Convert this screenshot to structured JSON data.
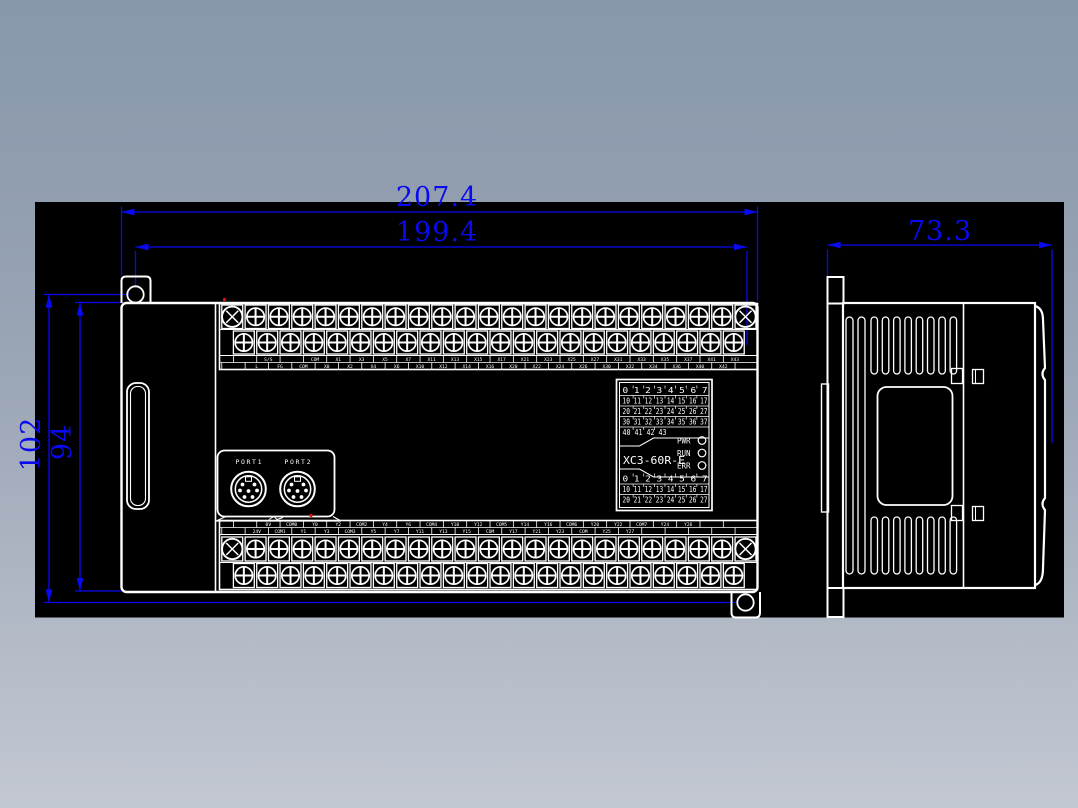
{
  "page": {
    "background_top": "#8897ab",
    "background_bottom": "#c3c8d2"
  },
  "canvas": {
    "fill": "#000000",
    "line_color": "#ffffff",
    "dimension_color": "#0a0af0",
    "marker_color": "#dd1111"
  },
  "dimensions": {
    "width_total": "207.4",
    "width_holes": "199.4",
    "height_total": "102",
    "height_body": "94",
    "side_depth": "73.3"
  },
  "front_view": {
    "model_label": "XC3-60R-E",
    "ports": [
      {
        "label": "PORT1"
      },
      {
        "label": "PORT2"
      }
    ],
    "leds": [
      {
        "label": "PWR"
      },
      {
        "label": "RUN"
      },
      {
        "label": "ERR"
      }
    ],
    "input_grid_rows": [
      "0 1 2 3 4 5 6 7",
      "10 11 12 13 14 15 16 17",
      "20 21 22 23 24 25 26 27",
      "30 31 32 33 34 35 36 37",
      "40 41 42 43"
    ],
    "output_grid_rows": [
      "0 1 2 3 4 5 6 7",
      "10 11 12 13 14 15 16 17",
      "20 21 22 23 24 25 26 27"
    ],
    "top_terminal_labels": {
      "upper_row": [
        "",
        "S/S",
        "",
        "COM",
        "X1",
        "X3",
        "X5",
        "X7",
        "X11",
        "X13",
        "X15",
        "X17",
        "X21",
        "X23",
        "X25",
        "X27",
        "X31",
        "X33",
        "X35",
        "X37",
        "X41",
        "X43"
      ],
      "lower_row": [
        "",
        "L",
        "FG",
        "COM",
        "X0",
        "X2",
        "X4",
        "X6",
        "X10",
        "X12",
        "X14",
        "X16",
        "X20",
        "X22",
        "X24",
        "X26",
        "X30",
        "X32",
        "X34",
        "X36",
        "X40",
        "X42",
        ""
      ]
    },
    "bottom_terminal_labels": {
      "upper_row": [
        "",
        "0V",
        "COM0",
        "Y0",
        "Y2",
        "COM2",
        "Y4",
        "Y6",
        "COM4",
        "Y10",
        "Y12",
        "COM5",
        "Y14",
        "Y16",
        "COM6",
        "Y20",
        "Y22",
        "COM7",
        "Y24",
        "Y26",
        "",
        ""
      ],
      "lower_row": [
        "",
        "24V",
        "COM1",
        "Y1",
        "Y3",
        "COM3",
        "Y5",
        "Y7",
        "Y11",
        "Y13",
        "Y15",
        "COM",
        "Y17",
        "Y21",
        "Y23",
        "COM",
        "Y25",
        "Y27",
        "",
        "",
        "",
        "",
        ""
      ]
    }
  }
}
